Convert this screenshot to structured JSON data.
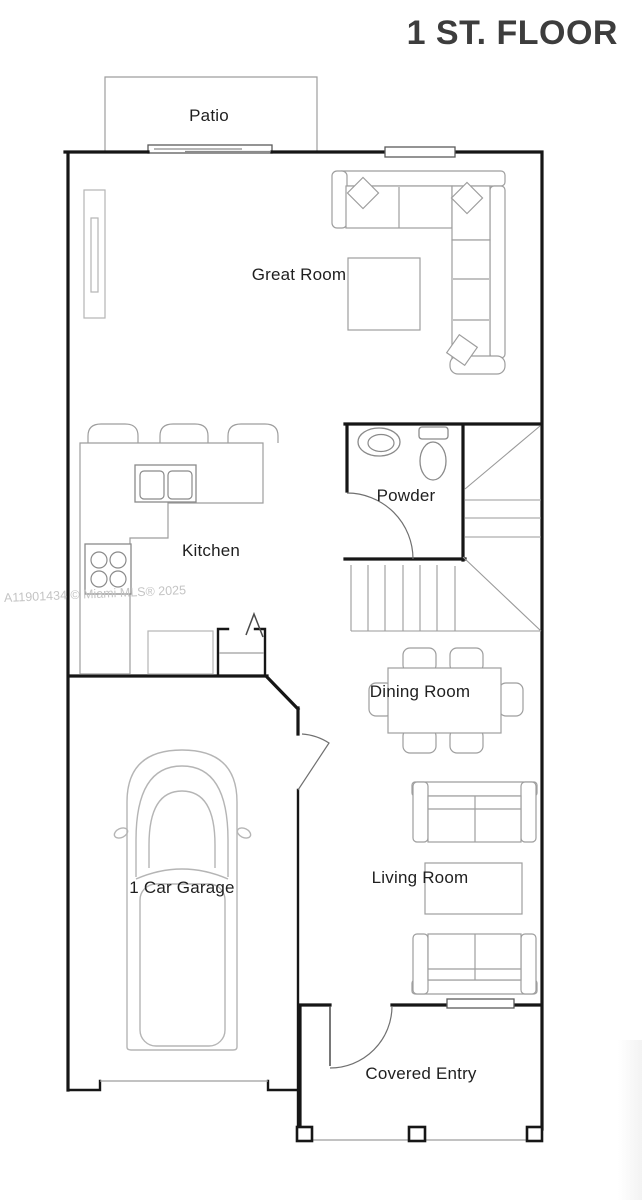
{
  "title": "1 ST. FLOOR",
  "watermark": "A11901434 © Miami MLS® 2025",
  "rooms": {
    "patio": "Patio",
    "great_room": "Great Room",
    "powder": "Powder",
    "kitchen": "Kitchen",
    "dining_room": "Dining Room",
    "garage": "1 Car Garage",
    "living_room": "Living Room",
    "covered_entry": "Covered Entry"
  },
  "colors": {
    "wall": "#161616",
    "furn": "#9e9e9e",
    "fixture": "#8a8a8a",
    "door": "#707070",
    "stair": "#9a9a9a",
    "text": "#1f1f1f",
    "title": "#3d3d3d",
    "watermark": "#c4c4c4"
  }
}
